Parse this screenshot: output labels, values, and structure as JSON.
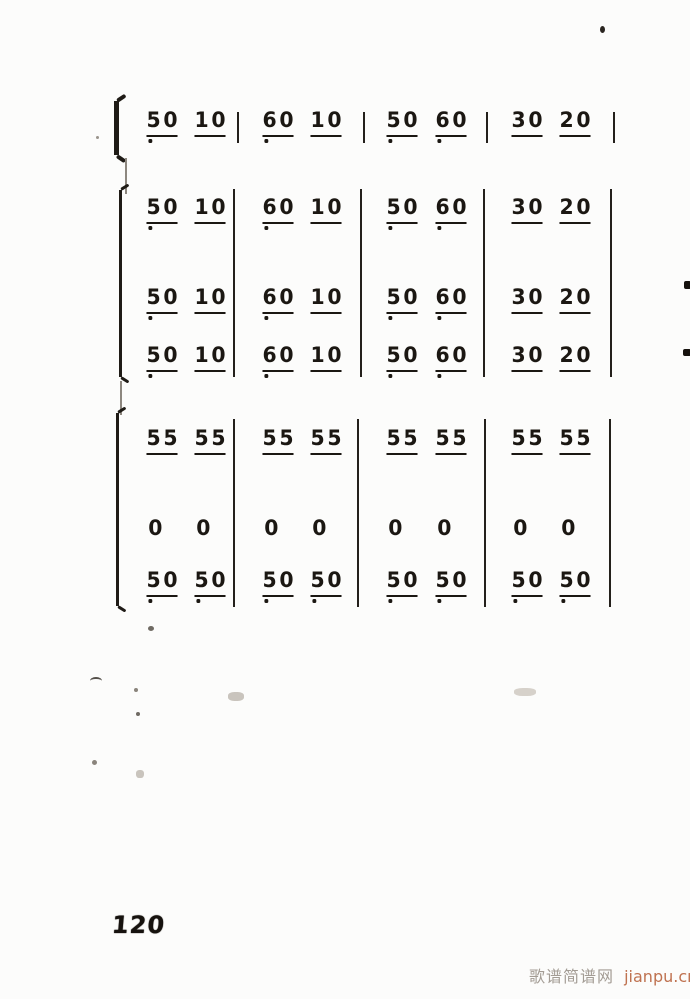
{
  "page": {
    "number": "120",
    "watermark_site": "歌谱简谱网",
    "watermark_url": "jianpu.cn",
    "ink_color": "#1b1712",
    "watermark_site_color": "#a39c94",
    "watermark_url_color": "#bf7250"
  },
  "score": {
    "notation": "jianpu-numbered-notation",
    "systems": [
      {
        "id": "system-1",
        "bracket": "brace",
        "rows": [
          {
            "measures": [
              {
                "groups": [
                  {
                    "digits": [
                      "5",
                      "0"
                    ],
                    "underline": true,
                    "dots": [
                      0
                    ]
                  },
                  {
                    "digits": [
                      "1",
                      "0"
                    ],
                    "underline": true,
                    "dots": []
                  }
                ]
              },
              {
                "groups": [
                  {
                    "digits": [
                      "6",
                      "0"
                    ],
                    "underline": true,
                    "dots": [
                      0
                    ]
                  },
                  {
                    "digits": [
                      "1",
                      "0"
                    ],
                    "underline": true,
                    "dots": []
                  }
                ]
              },
              {
                "groups": [
                  {
                    "digits": [
                      "5",
                      "0"
                    ],
                    "underline": true,
                    "dots": [
                      0
                    ]
                  },
                  {
                    "digits": [
                      "6",
                      "0"
                    ],
                    "underline": true,
                    "dots": [
                      0
                    ]
                  }
                ]
              },
              {
                "groups": [
                  {
                    "digits": [
                      "3",
                      "0"
                    ],
                    "underline": true,
                    "dots": []
                  },
                  {
                    "digits": [
                      "2",
                      "0"
                    ],
                    "underline": true,
                    "dots": []
                  }
                ]
              }
            ]
          }
        ]
      },
      {
        "id": "system-2",
        "bracket": "bracket",
        "rows": [
          {
            "measures": [
              {
                "groups": [
                  {
                    "digits": [
                      "5",
                      "0"
                    ],
                    "underline": true,
                    "dots": [
                      0
                    ]
                  },
                  {
                    "digits": [
                      "1",
                      "0"
                    ],
                    "underline": true,
                    "dots": []
                  }
                ]
              },
              {
                "groups": [
                  {
                    "digits": [
                      "6",
                      "0"
                    ],
                    "underline": true,
                    "dots": [
                      0
                    ]
                  },
                  {
                    "digits": [
                      "1",
                      "0"
                    ],
                    "underline": true,
                    "dots": []
                  }
                ]
              },
              {
                "groups": [
                  {
                    "digits": [
                      "5",
                      "0"
                    ],
                    "underline": true,
                    "dots": [
                      0
                    ]
                  },
                  {
                    "digits": [
                      "6",
                      "0"
                    ],
                    "underline": true,
                    "dots": [
                      0
                    ]
                  }
                ]
              },
              {
                "groups": [
                  {
                    "digits": [
                      "3",
                      "0"
                    ],
                    "underline": true,
                    "dots": []
                  },
                  {
                    "digits": [
                      "2",
                      "0"
                    ],
                    "underline": true,
                    "dots": []
                  }
                ]
              }
            ]
          },
          {
            "measures": [
              {
                "groups": [
                  {
                    "digits": [
                      "5",
                      "0"
                    ],
                    "underline": true,
                    "dots": [
                      0
                    ]
                  },
                  {
                    "digits": [
                      "1",
                      "0"
                    ],
                    "underline": true,
                    "dots": []
                  }
                ]
              },
              {
                "groups": [
                  {
                    "digits": [
                      "6",
                      "0"
                    ],
                    "underline": true,
                    "dots": [
                      0
                    ]
                  },
                  {
                    "digits": [
                      "1",
                      "0"
                    ],
                    "underline": true,
                    "dots": []
                  }
                ]
              },
              {
                "groups": [
                  {
                    "digits": [
                      "5",
                      "0"
                    ],
                    "underline": true,
                    "dots": [
                      0
                    ]
                  },
                  {
                    "digits": [
                      "6",
                      "0"
                    ],
                    "underline": true,
                    "dots": [
                      0
                    ]
                  }
                ]
              },
              {
                "groups": [
                  {
                    "digits": [
                      "3",
                      "0"
                    ],
                    "underline": true,
                    "dots": []
                  },
                  {
                    "digits": [
                      "2",
                      "0"
                    ],
                    "underline": true,
                    "dots": []
                  }
                ]
              }
            ]
          },
          {
            "measures": [
              {
                "groups": [
                  {
                    "digits": [
                      "5",
                      "0"
                    ],
                    "underline": true,
                    "dots": [
                      0
                    ]
                  },
                  {
                    "digits": [
                      "1",
                      "0"
                    ],
                    "underline": true,
                    "dots": []
                  }
                ]
              },
              {
                "groups": [
                  {
                    "digits": [
                      "6",
                      "0"
                    ],
                    "underline": true,
                    "dots": [
                      0
                    ]
                  },
                  {
                    "digits": [
                      "1",
                      "0"
                    ],
                    "underline": true,
                    "dots": []
                  }
                ]
              },
              {
                "groups": [
                  {
                    "digits": [
                      "5",
                      "0"
                    ],
                    "underline": true,
                    "dots": [
                      0
                    ]
                  },
                  {
                    "digits": [
                      "6",
                      "0"
                    ],
                    "underline": true,
                    "dots": [
                      0
                    ]
                  }
                ]
              },
              {
                "groups": [
                  {
                    "digits": [
                      "3",
                      "0"
                    ],
                    "underline": true,
                    "dots": []
                  },
                  {
                    "digits": [
                      "2",
                      "0"
                    ],
                    "underline": true,
                    "dots": []
                  }
                ]
              }
            ]
          }
        ]
      },
      {
        "id": "system-3",
        "bracket": "bracket",
        "rows": [
          {
            "measures": [
              {
                "groups": [
                  {
                    "digits": [
                      "5",
                      "5"
                    ],
                    "underline": true,
                    "dots": []
                  },
                  {
                    "digits": [
                      "5",
                      "5"
                    ],
                    "underline": true,
                    "dots": []
                  }
                ]
              },
              {
                "groups": [
                  {
                    "digits": [
                      "5",
                      "5"
                    ],
                    "underline": true,
                    "dots": []
                  },
                  {
                    "digits": [
                      "5",
                      "5"
                    ],
                    "underline": true,
                    "dots": []
                  }
                ]
              },
              {
                "groups": [
                  {
                    "digits": [
                      "5",
                      "5"
                    ],
                    "underline": true,
                    "dots": []
                  },
                  {
                    "digits": [
                      "5",
                      "5"
                    ],
                    "underline": true,
                    "dots": []
                  }
                ]
              },
              {
                "groups": [
                  {
                    "digits": [
                      "5",
                      "5"
                    ],
                    "underline": true,
                    "dots": []
                  },
                  {
                    "digits": [
                      "5",
                      "5"
                    ],
                    "underline": true,
                    "dots": []
                  }
                ]
              }
            ]
          },
          {
            "measures": [
              {
                "groups": [
                  {
                    "digits": [
                      "0"
                    ],
                    "underline": false,
                    "dots": []
                  },
                  {
                    "digits": [
                      "0"
                    ],
                    "underline": false,
                    "dots": []
                  }
                ]
              },
              {
                "groups": [
                  {
                    "digits": [
                      "0"
                    ],
                    "underline": false,
                    "dots": []
                  },
                  {
                    "digits": [
                      "0"
                    ],
                    "underline": false,
                    "dots": []
                  }
                ]
              },
              {
                "groups": [
                  {
                    "digits": [
                      "0"
                    ],
                    "underline": false,
                    "dots": []
                  },
                  {
                    "digits": [
                      "0"
                    ],
                    "underline": false,
                    "dots": []
                  }
                ]
              },
              {
                "groups": [
                  {
                    "digits": [
                      "0"
                    ],
                    "underline": false,
                    "dots": []
                  },
                  {
                    "digits": [
                      "0"
                    ],
                    "underline": false,
                    "dots": []
                  }
                ]
              }
            ]
          },
          {
            "measures": [
              {
                "groups": [
                  {
                    "digits": [
                      "5",
                      "0"
                    ],
                    "underline": true,
                    "dots": [
                      0
                    ]
                  },
                  {
                    "digits": [
                      "5",
                      "0"
                    ],
                    "underline": true,
                    "dots": [
                      0
                    ]
                  }
                ]
              },
              {
                "groups": [
                  {
                    "digits": [
                      "5",
                      "0"
                    ],
                    "underline": true,
                    "dots": [
                      0
                    ]
                  },
                  {
                    "digits": [
                      "5",
                      "0"
                    ],
                    "underline": true,
                    "dots": [
                      0
                    ]
                  }
                ]
              },
              {
                "groups": [
                  {
                    "digits": [
                      "5",
                      "0"
                    ],
                    "underline": true,
                    "dots": [
                      0
                    ]
                  },
                  {
                    "digits": [
                      "5",
                      "0"
                    ],
                    "underline": true,
                    "dots": [
                      0
                    ]
                  }
                ]
              },
              {
                "groups": [
                  {
                    "digits": [
                      "5",
                      "0"
                    ],
                    "underline": true,
                    "dots": [
                      0
                    ]
                  },
                  {
                    "digits": [
                      "5",
                      "0"
                    ],
                    "underline": true,
                    "dots": [
                      0
                    ]
                  }
                ]
              }
            ]
          }
        ]
      }
    ]
  }
}
